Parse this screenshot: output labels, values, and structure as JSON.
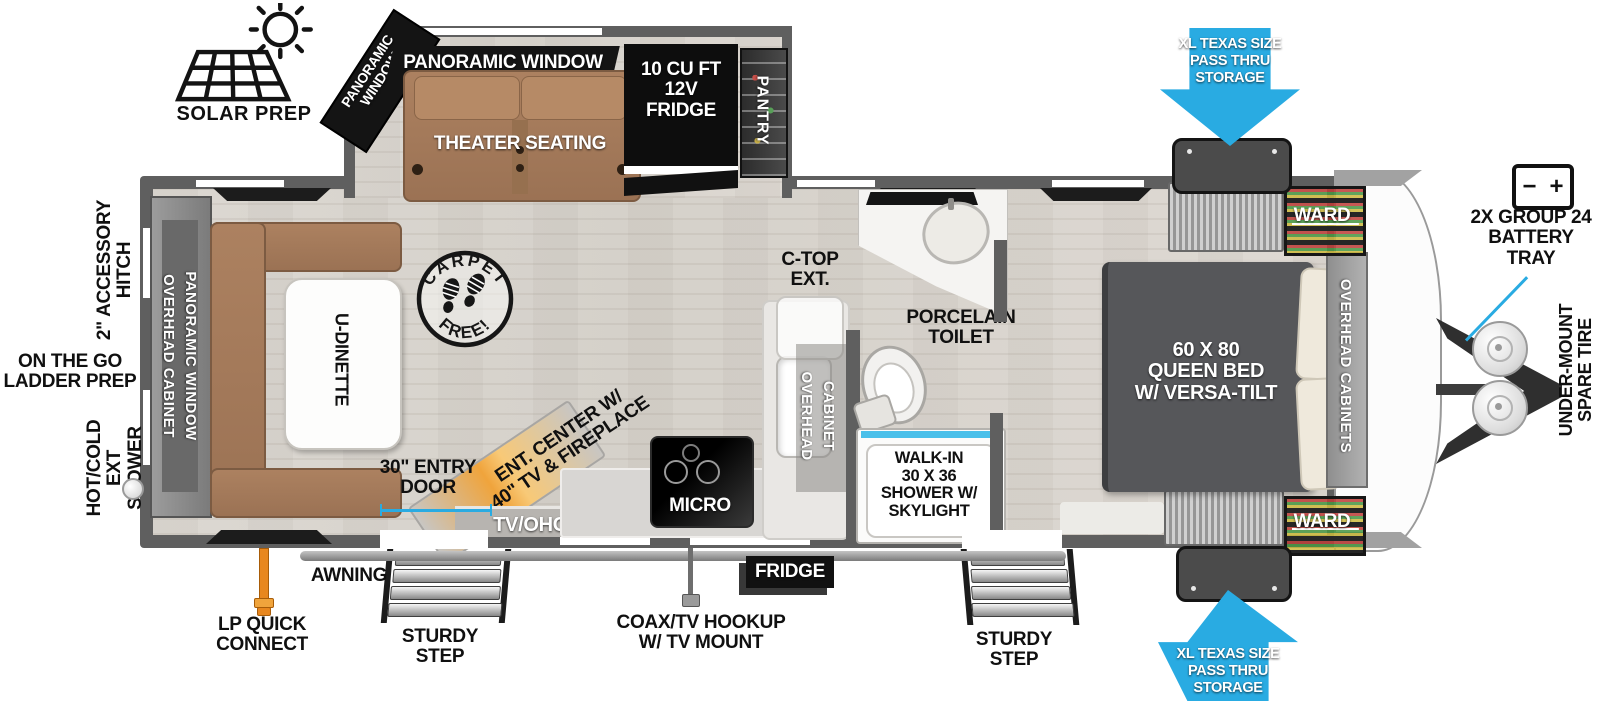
{
  "colors": {
    "accent_blue": "#29abe2",
    "wall_gray": "#5f5f5f",
    "bed_gray": "#57585b",
    "furniture_brown": "#a3795a",
    "fireplace_orange": "#f0a43c",
    "lp_orange": "#e8871e"
  },
  "exterior_labels": {
    "solar_prep": "SOLAR PREP",
    "pass_thru_top": "XL TEXAS SIZE\nPASS THRU\nSTORAGE",
    "pass_thru_bottom": "XL TEXAS SIZE\nPASS THRU\nSTORAGE",
    "battery_tray": "2X GROUP 24\nBATTERY\nTRAY",
    "battery_minus": "−",
    "battery_plus": "+",
    "under_mount_spare_tire": "UNDER-MOUNT\nSPARE TIRE",
    "accessory_hitch": "2\" ACCESSORY\nHITCH",
    "ladder_prep": "ON THE GO\nLADDER PREP",
    "ext_shower": "HOT/COLD\nEXT SHOWER",
    "lp_quick_connect": "LP QUICK\nCONNECT",
    "awning": "AWNING",
    "sturdy_step_left": "STURDY\nSTEP",
    "sturdy_step_right": "STURDY\nSTEP",
    "coax_tv_hookup": "COAX/TV HOOKUP\nW/ TV MOUNT",
    "fridge_compartment": "FRIDGE",
    "entry_door": "30\" ENTRY\nDOOR"
  },
  "living_area": {
    "panoramic_window_top": "PANORAMIC WINDOW",
    "panoramic_window_angled": "PANORAMIC\nWINDOW",
    "theater_seating": "THEATER SEATING",
    "fridge": "10 CU FT\n12V\nFRIDGE",
    "pantry": "PANTRY",
    "carpet_free_top": "CARPET",
    "carpet_free_bottom": "FREE!",
    "u_dinette": "U-DINETTE",
    "rear_cabinet_col1": "OVERHEAD CABINET",
    "rear_cabinet_col2": "PANORAMIC WINDOW",
    "ent_center": "ENT. CENTER W/\n40\" TV & FIREPLACE",
    "tv_ohc": "TV/OHC"
  },
  "kitchen": {
    "micro": "MICRO",
    "overhead_cabinet_col1": "OVERHEAD",
    "overhead_cabinet_col2": "CABINET",
    "ctop_ext": "C-TOP\nEXT."
  },
  "bathroom": {
    "porcelain_toilet": "PORCELAIN\nTOILET",
    "shower": "WALK-IN\n30 X 36\nSHOWER W/\nSKYLIGHT"
  },
  "bedroom": {
    "bed": "60 X  80\nQUEEN BED\nW/ VERSA-TILT",
    "overhead_cabinets": "OVERHEAD CABINETS",
    "ward_top": "WARD",
    "ward_bottom": "WARD"
  }
}
